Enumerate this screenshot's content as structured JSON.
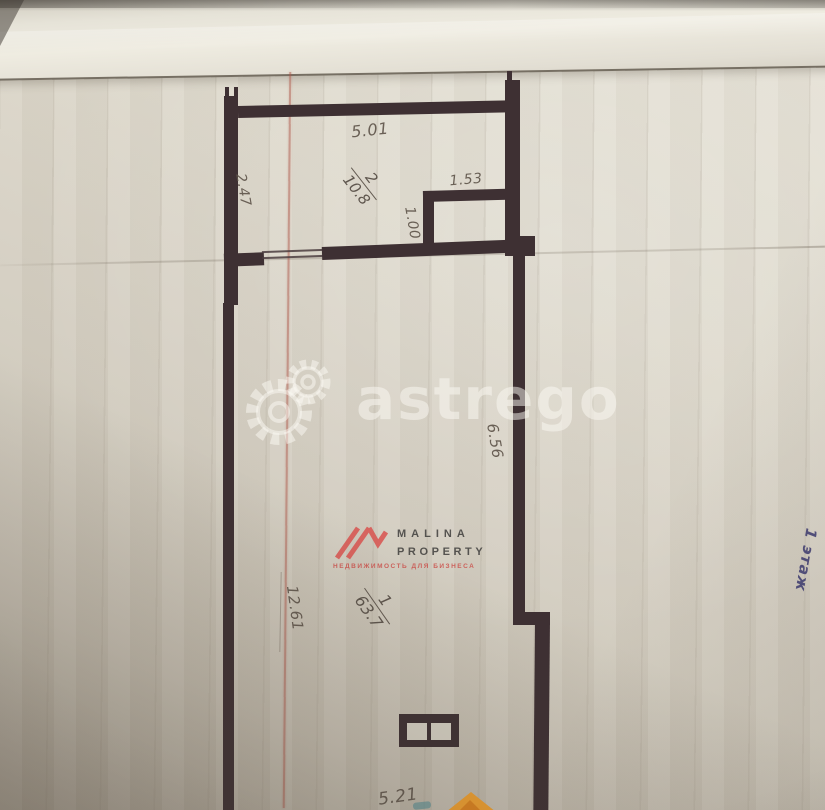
{
  "plan": {
    "rooms": [
      {
        "number": "2",
        "area": "10.8"
      },
      {
        "number": "1",
        "area": "63.7"
      }
    ],
    "dimensions": {
      "top_width": "5.01",
      "room2_height": "2.47",
      "closet_width": "1.53",
      "closet_depth": "1.00",
      "right_upper": "6.56",
      "left_height": "12.61",
      "bottom_width": "5.21"
    },
    "floor_label": "1 этаж"
  },
  "watermarks": {
    "astrego_text": "astrego",
    "malina_line1": "MALINA",
    "malina_line2": "PROPERTY",
    "malina_subtitle": "НЕДВИЖИМОСТЬ ДЛЯ БИЗНЕСА"
  },
  "colors": {
    "wall": "#3e3033",
    "paper": "#d6d1c4",
    "dimension_text": "#5d5349",
    "floor_label_ink": "#3f3d73",
    "malina_red": "#d9534f",
    "marker_orange": "#f0a030",
    "red_crease": "#ac5446"
  }
}
